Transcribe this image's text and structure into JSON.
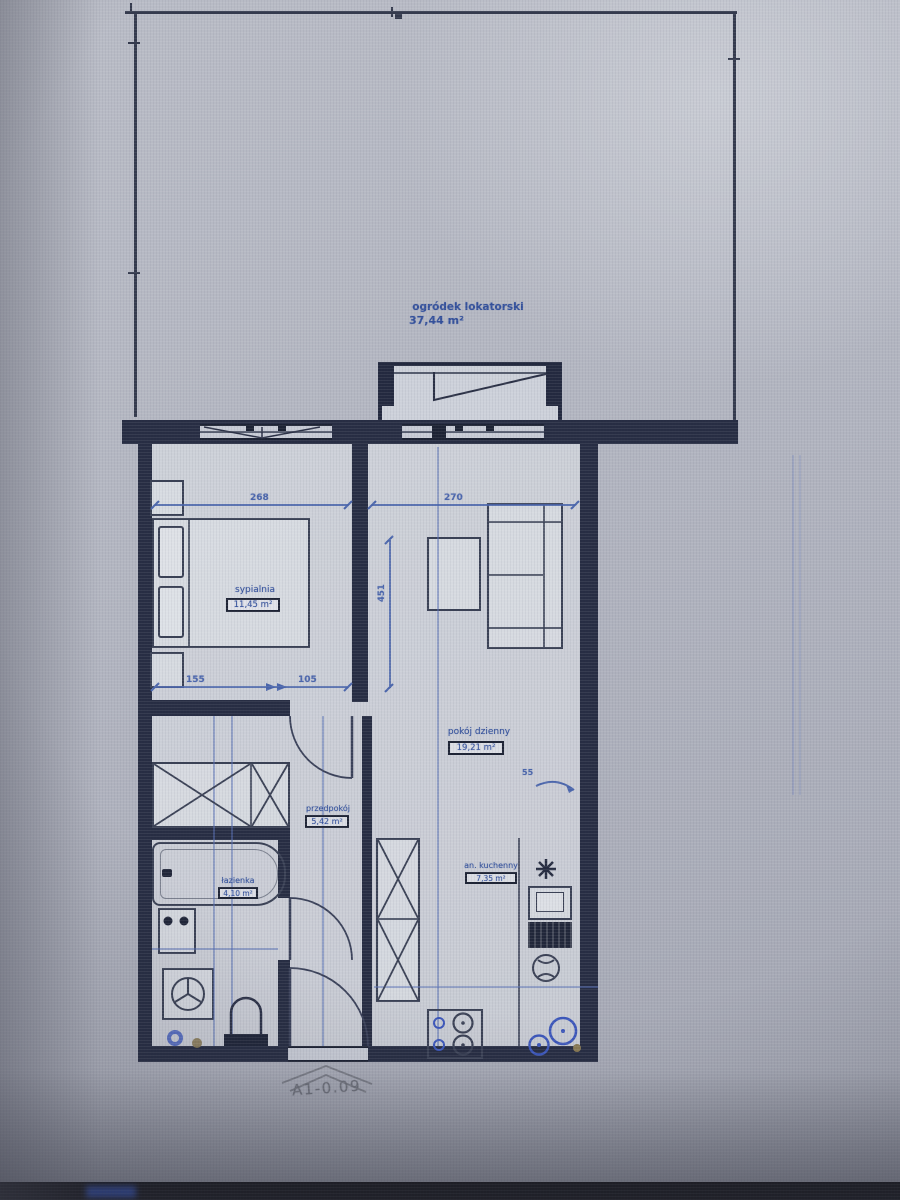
{
  "unit_code": "A1-0.09",
  "garden": {
    "name": "ogródek lokatorski",
    "area": "37,44 m²"
  },
  "rooms": {
    "bedroom": {
      "name": "sypialnia",
      "area": "11,45 m²"
    },
    "living": {
      "name": "pokój dzienny",
      "area": "19,21 m²"
    },
    "hall": {
      "name": "przedpokój",
      "area": "5,42 m²"
    },
    "bath": {
      "name": "łazienka",
      "area": "4,10 m²"
    },
    "kitchen": {
      "name": "an. kuchenny",
      "area": "7,35 m²"
    }
  },
  "dimensions": {
    "bedroom_width": "268",
    "living_width": "270",
    "bedroom_seg_left": "155",
    "bedroom_seg_right": "105",
    "living_depth": "451",
    "wall_detail": "55"
  },
  "fixtures": [
    "bed",
    "nightstand",
    "sofa",
    "coffee-table",
    "wardrobe",
    "tall-cabinet",
    "bathtub",
    "washbasin",
    "washing-machine",
    "toilet",
    "floor-drain",
    "oven",
    "fridge",
    "kitchen-sink",
    "hob",
    "light-point",
    "fan"
  ],
  "colors": {
    "background": "#b3b6c1",
    "wall": "#272d44",
    "furniture_line": "#3a4156",
    "dimension_blue": "#4a66b0",
    "label_blue": "#31509f",
    "plumbing_blue": "#3a57c0",
    "photo_bar": "#0b0b0e"
  }
}
